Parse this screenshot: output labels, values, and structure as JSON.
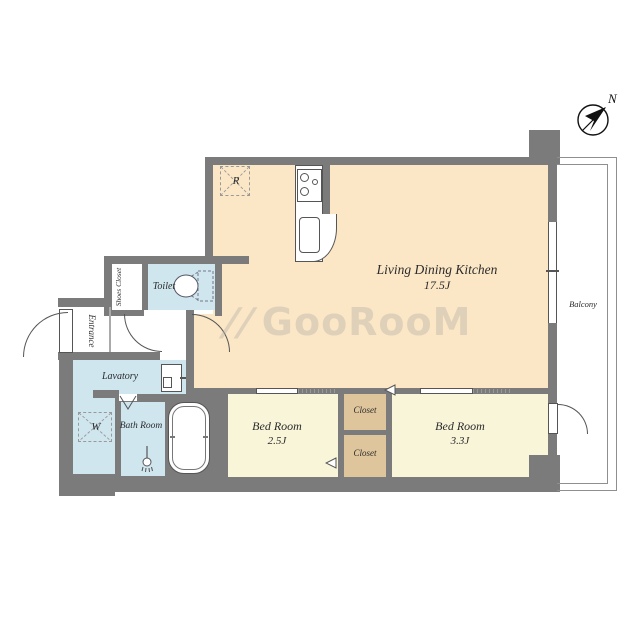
{
  "plan": {
    "rooms": {
      "ldk": {
        "label": "Living Dining Kitchen",
        "size": "17.5J"
      },
      "bedroom1": {
        "label": "Bed Room",
        "size": "2.5J"
      },
      "bedroom2": {
        "label": "Bed Room",
        "size": "3.3J"
      },
      "closet1": {
        "label": "Closet"
      },
      "closet2": {
        "label": "Closet"
      },
      "toilet": {
        "label": "Toilet"
      },
      "lavatory": {
        "label": "Lavatory"
      },
      "bathroom": {
        "label": "Bath Room"
      },
      "entrance": {
        "label": "Entrance"
      },
      "shoes_closet": {
        "label": "Shoes Closet"
      },
      "balcony": {
        "label": "Balcony"
      }
    },
    "marks": {
      "refrigerator": "R",
      "washer": "W",
      "compass_north": "N"
    },
    "watermark": {
      "mark": "//",
      "text": "GooRooM"
    },
    "colors": {
      "wall": "#7b7b7b",
      "ldk": "#fbe7c6",
      "bedroom": "#f9f5d9",
      "closet": "#dfc59c",
      "water": "#cfe6ef"
    }
  }
}
